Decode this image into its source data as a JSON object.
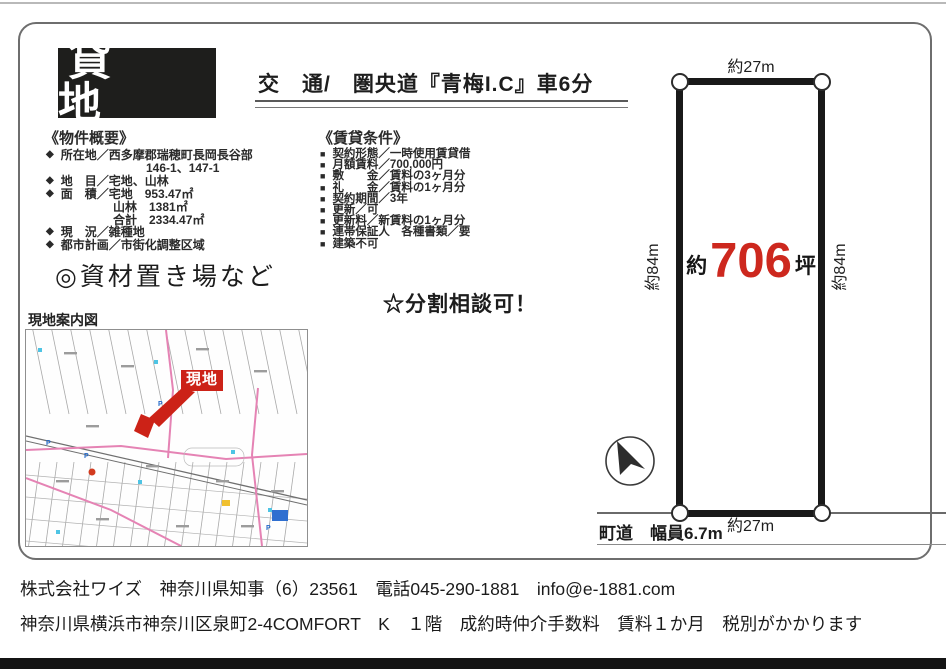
{
  "banner": {
    "label": "貸　地"
  },
  "transport": {
    "text": "交　通/　圏央道『青梅I.C』車6分"
  },
  "overview": {
    "heading": "《物件概要》",
    "bullet": "◆",
    "items": [
      {
        "text": "所在地／西多摩郡瑞穂町長岡長谷部",
        "sub": [
          "146-1、147-1"
        ]
      },
      {
        "text": "地　目／宅地、山林",
        "sub": []
      },
      {
        "text": "面　積／宅地　953.47㎡",
        "sub": [
          "山林　1381㎡",
          "合計　2334.47㎡"
        ]
      },
      {
        "text": "現　況／雑種地",
        "sub": []
      },
      {
        "text": "都市計画／市街化調整区域",
        "sub": []
      }
    ]
  },
  "conditions": {
    "heading": "《賃貸条件》",
    "bullet": "■",
    "items": [
      "契約形態／一時使用賃貸借",
      "月額賃料／700,000円",
      "敷　　金／賃料の3ヶ月分",
      "礼　　金／賃料の1ヶ月分",
      "契約期間／3年",
      "更新／可",
      "更新料／新賃料の1ヶ月分",
      "連帯保証人　各種書類／要",
      "建築不可"
    ]
  },
  "usage_note": "◎資材置き場など",
  "split_note": "☆分割相談可！",
  "map": {
    "title": "現地案内図",
    "marker_label": "現地",
    "parking_label": "P"
  },
  "plot": {
    "top_width": "約27m",
    "bottom_width": "約27m",
    "left_depth": "約84m",
    "right_depth": "約84m",
    "area_prefix": "約",
    "area_value": "706",
    "area_unit": "坪",
    "road_label": "町道　幅員6.7m"
  },
  "footer": {
    "line1": "株式会社ワイズ　神奈川県知事（6）23561　電話045-290-1881　info@e-1881.com",
    "line2": "神奈川県横浜市神奈川区泉町2-4COMFORT　K　１階　成約時仲介手数料　賃料１か月　税別がかかります"
  },
  "colors": {
    "accent_red": "#cd281e",
    "map_road_pink": "#e583b4",
    "banner_black": "#1e1e1c"
  }
}
